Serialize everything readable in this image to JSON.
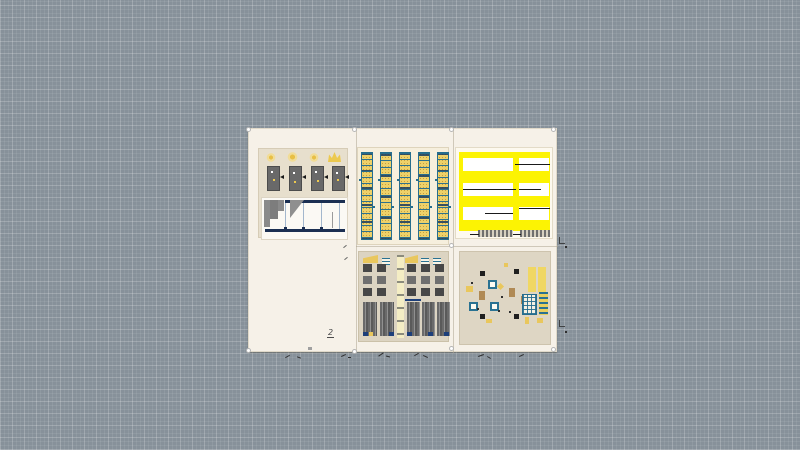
{
  "canvas": {
    "background_color": "#87919a",
    "grid_line_color": "#9ba5ad"
  },
  "board": {
    "background_color": "#f6f1e8",
    "sheet_count": 5
  },
  "annotations": {
    "sheet_number_label": "2"
  },
  "palette": {
    "highlight_yellow": "#fcf303",
    "drawing_yellow": "#eecf5e",
    "teal": "#2a7292",
    "navy": "#1c3a6b",
    "gray": "#6e6e6e",
    "sheet_tan": "#e6decb",
    "paper_white": "#fbf8f0"
  },
  "sheets": [
    {
      "id": "elevation-details",
      "position": "top-left"
    },
    {
      "id": "schedules",
      "position": "top-center"
    },
    {
      "id": "highlighted-plans",
      "position": "top-right"
    },
    {
      "id": "framing-details",
      "position": "bottom-center"
    },
    {
      "id": "site-details",
      "position": "bottom-right"
    }
  ]
}
